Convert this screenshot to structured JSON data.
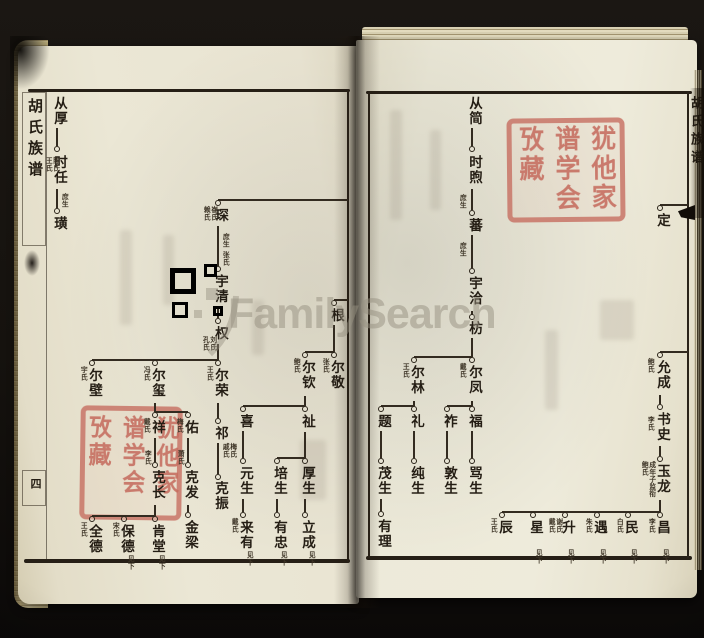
{
  "watermark": {
    "text": "FamilySearch"
  },
  "left_margin": {
    "title": "胡氏族谱",
    "page_mark": "四"
  },
  "right_margin": {
    "title": "胡氏族谱"
  },
  "seal": {
    "text": "犹他家谱学会攷藏"
  },
  "tree": {
    "labels": [
      {
        "t": "从厚",
        "x": 57,
        "y": 96
      },
      {
        "t": "时任",
        "x": 57,
        "y": 155
      },
      {
        "t": "璜",
        "x": 57,
        "y": 216
      },
      {
        "t": "琛",
        "x": 218,
        "y": 208
      },
      {
        "t": "宇清",
        "x": 218,
        "y": 274
      },
      {
        "t": "权",
        "x": 218,
        "y": 326
      },
      {
        "t": "尔壁",
        "x": 92,
        "y": 368
      },
      {
        "t": "尔玺",
        "x": 155,
        "y": 368
      },
      {
        "t": "尔荣",
        "x": 218,
        "y": 368
      },
      {
        "t": "祁",
        "x": 218,
        "y": 426
      },
      {
        "t": "克振",
        "x": 218,
        "y": 481
      },
      {
        "t": "祥",
        "x": 155,
        "y": 420
      },
      {
        "t": "佑",
        "x": 188,
        "y": 420
      },
      {
        "t": "克长",
        "x": 155,
        "y": 470
      },
      {
        "t": "克发",
        "x": 188,
        "y": 470
      },
      {
        "t": "金梁",
        "x": 188,
        "y": 520
      },
      {
        "t": "全德",
        "x": 92,
        "y": 524
      },
      {
        "t": "保德",
        "x": 124,
        "y": 524
      },
      {
        "t": "肯堂",
        "x": 155,
        "y": 524
      },
      {
        "t": "根",
        "x": 334,
        "y": 308
      },
      {
        "t": "尔敬",
        "x": 334,
        "y": 360
      },
      {
        "t": "尔钦",
        "x": 305,
        "y": 360
      },
      {
        "t": "喜",
        "x": 243,
        "y": 414
      },
      {
        "t": "祉",
        "x": 305,
        "y": 414
      },
      {
        "t": "元生",
        "x": 243,
        "y": 466
      },
      {
        "t": "来有",
        "x": 243,
        "y": 520
      },
      {
        "t": "培生",
        "x": 277,
        "y": 466
      },
      {
        "t": "厚生",
        "x": 305,
        "y": 466
      },
      {
        "t": "有忠",
        "x": 277,
        "y": 520
      },
      {
        "t": "立成",
        "x": 305,
        "y": 520
      },
      {
        "t": "从简",
        "x": 472,
        "y": 96
      },
      {
        "t": "时煦",
        "x": 472,
        "y": 155
      },
      {
        "t": "蕃",
        "x": 472,
        "y": 218
      },
      {
        "t": "宇洽",
        "x": 472,
        "y": 276
      },
      {
        "t": "枋",
        "x": 472,
        "y": 321
      },
      {
        "t": "尔凤",
        "x": 472,
        "y": 365
      },
      {
        "t": "尔林",
        "x": 414,
        "y": 365
      },
      {
        "t": "祚",
        "x": 447,
        "y": 414
      },
      {
        "t": "福",
        "x": 472,
        "y": 414
      },
      {
        "t": "敦生",
        "x": 447,
        "y": 466
      },
      {
        "t": "骂生",
        "x": 472,
        "y": 466
      },
      {
        "t": "题",
        "x": 381,
        "y": 414
      },
      {
        "t": "礼",
        "x": 414,
        "y": 414
      },
      {
        "t": "茂生",
        "x": 381,
        "y": 466
      },
      {
        "t": "纯生",
        "x": 414,
        "y": 466
      },
      {
        "t": "有理",
        "x": 381,
        "y": 519
      },
      {
        "t": "定",
        "x": 660,
        "y": 213
      },
      {
        "t": "允成",
        "x": 660,
        "y": 360
      },
      {
        "t": "书史",
        "x": 660,
        "y": 412
      },
      {
        "t": "玉龙",
        "x": 660,
        "y": 464
      },
      {
        "t": "辰",
        "x": 502,
        "y": 520
      },
      {
        "t": "星",
        "x": 533,
        "y": 520
      },
      {
        "t": "升",
        "x": 565,
        "y": 520
      },
      {
        "t": "遇",
        "x": 597,
        "y": 520
      },
      {
        "t": "民",
        "x": 628,
        "y": 520
      },
      {
        "t": "昌",
        "x": 660,
        "y": 520
      }
    ],
    "annots": [
      {
        "t": "陈氏王氏",
        "x": 48,
        "y": 157,
        "h": 16
      },
      {
        "t": "庶生",
        "x": 64,
        "y": 193
      },
      {
        "t": "崔氏赖氏",
        "x": 206,
        "y": 206,
        "h": 16
      },
      {
        "t": "庶生",
        "x": 225,
        "y": 233
      },
      {
        "t": "张氏",
        "x": 225,
        "y": 251
      },
      {
        "t": "刘氏孔氏",
        "x": 205,
        "y": 336,
        "h": 16
      },
      {
        "t": "宇氏",
        "x": 83,
        "y": 366
      },
      {
        "t": "冯氏",
        "x": 146,
        "y": 366
      },
      {
        "t": "王氏",
        "x": 209,
        "y": 366
      },
      {
        "t": "梅氏戚氏",
        "x": 225,
        "y": 443,
        "h": 16
      },
      {
        "t": "戴氏",
        "x": 146,
        "y": 418
      },
      {
        "t": "梅氏",
        "x": 179,
        "y": 418
      },
      {
        "t": "李氏",
        "x": 147,
        "y": 450
      },
      {
        "t": "萧氏",
        "x": 180,
        "y": 450
      },
      {
        "t": "王氏",
        "x": 83,
        "y": 522
      },
      {
        "t": "宋氏",
        "x": 115,
        "y": 522
      },
      {
        "t": "见下",
        "x": 130,
        "y": 555
      },
      {
        "t": "见下",
        "x": 161,
        "y": 555
      },
      {
        "t": "张氏",
        "x": 325,
        "y": 358
      },
      {
        "t": "鲍氏",
        "x": 296,
        "y": 358
      },
      {
        "t": "戴氏",
        "x": 234,
        "y": 518
      },
      {
        "t": "见下",
        "x": 249,
        "y": 551
      },
      {
        "t": "见下",
        "x": 283,
        "y": 551
      },
      {
        "t": "见下",
        "x": 311,
        "y": 551
      },
      {
        "t": "庶生",
        "x": 462,
        "y": 194
      },
      {
        "t": "庶生",
        "x": 462,
        "y": 242
      },
      {
        "t": "戴氏",
        "x": 462,
        "y": 363
      },
      {
        "t": "王氏",
        "x": 405,
        "y": 363
      },
      {
        "t": "鲍氏",
        "x": 650,
        "y": 358
      },
      {
        "t": "李氏",
        "x": 650,
        "y": 416
      },
      {
        "t": "成年子监衔鲍氏",
        "x": 644,
        "y": 461,
        "h": 38
      },
      {
        "t": "王氏",
        "x": 493,
        "y": 518
      },
      {
        "t": "谢氏戴氏",
        "x": 551,
        "y": 518,
        "h": 16
      },
      {
        "t": "朱氏",
        "x": 588,
        "y": 518
      },
      {
        "t": "白氏",
        "x": 619,
        "y": 518
      },
      {
        "t": "李氏",
        "x": 651,
        "y": 518
      },
      {
        "t": "见下",
        "x": 538,
        "y": 549
      },
      {
        "t": "见下",
        "x": 570,
        "y": 549
      },
      {
        "t": "见下",
        "x": 602,
        "y": 549
      },
      {
        "t": "见下",
        "x": 633,
        "y": 549
      },
      {
        "t": "见下",
        "x": 665,
        "y": 549
      }
    ],
    "circles": [
      [
        57,
        149
      ],
      [
        57,
        211
      ],
      [
        218,
        203
      ],
      [
        218,
        269
      ],
      [
        218,
        321
      ],
      [
        92,
        363
      ],
      [
        155,
        363
      ],
      [
        218,
        363
      ],
      [
        218,
        421
      ],
      [
        218,
        477
      ],
      [
        155,
        415
      ],
      [
        188,
        415
      ],
      [
        155,
        465
      ],
      [
        188,
        465
      ],
      [
        188,
        515
      ],
      [
        92,
        519
      ],
      [
        124,
        519
      ],
      [
        155,
        519
      ],
      [
        334,
        303
      ],
      [
        305,
        355
      ],
      [
        334,
        355
      ],
      [
        243,
        409
      ],
      [
        305,
        409
      ],
      [
        243,
        461
      ],
      [
        243,
        515
      ],
      [
        277,
        461
      ],
      [
        305,
        461
      ],
      [
        277,
        515
      ],
      [
        305,
        515
      ],
      [
        472,
        149
      ],
      [
        472,
        213
      ],
      [
        472,
        271
      ],
      [
        472,
        317
      ],
      [
        414,
        360
      ],
      [
        472,
        360
      ],
      [
        447,
        409
      ],
      [
        472,
        409
      ],
      [
        381,
        409
      ],
      [
        414,
        409
      ],
      [
        447,
        461
      ],
      [
        472,
        461
      ],
      [
        381,
        461
      ],
      [
        414,
        461
      ],
      [
        381,
        514
      ],
      [
        660,
        208
      ],
      [
        660,
        355
      ],
      [
        660,
        407
      ],
      [
        660,
        459
      ],
      [
        502,
        515
      ],
      [
        533,
        515
      ],
      [
        565,
        515
      ],
      [
        597,
        515
      ],
      [
        628,
        515
      ],
      [
        660,
        515
      ]
    ],
    "vlines": [
      [
        57,
        128,
        146
      ],
      [
        57,
        189,
        208
      ],
      [
        218,
        226,
        266
      ],
      [
        218,
        309,
        318
      ],
      [
        218,
        344,
        360
      ],
      [
        218,
        403,
        418
      ],
      [
        218,
        443,
        474
      ],
      [
        155,
        403,
        412
      ],
      [
        155,
        438,
        462
      ],
      [
        188,
        438,
        462
      ],
      [
        188,
        505,
        512
      ],
      [
        155,
        505,
        516
      ],
      [
        334,
        325,
        352
      ],
      [
        305,
        396,
        406
      ],
      [
        243,
        431,
        458
      ],
      [
        243,
        499,
        512
      ],
      [
        305,
        432,
        458
      ],
      [
        277,
        499,
        512
      ],
      [
        305,
        499,
        512
      ],
      [
        472,
        128,
        146
      ],
      [
        472,
        189,
        210
      ],
      [
        472,
        235,
        268
      ],
      [
        472,
        311,
        315
      ],
      [
        472,
        338,
        357
      ],
      [
        472,
        401,
        406
      ],
      [
        414,
        401,
        406
      ],
      [
        447,
        431,
        458
      ],
      [
        472,
        431,
        458
      ],
      [
        381,
        431,
        458
      ],
      [
        414,
        431,
        458
      ],
      [
        381,
        499,
        511
      ],
      [
        660,
        395,
        404
      ],
      [
        660,
        446,
        456
      ],
      [
        660,
        500,
        512
      ]
    ],
    "hlines": [
      [
        200,
        218,
        348
      ],
      [
        300,
        334,
        348
      ],
      [
        360,
        92,
        218
      ],
      [
        412,
        155,
        188
      ],
      [
        516,
        92,
        155
      ],
      [
        352,
        305,
        334
      ],
      [
        406,
        243,
        305
      ],
      [
        458,
        277,
        305
      ],
      [
        357,
        414,
        472
      ],
      [
        406,
        447,
        472
      ],
      [
        406,
        381,
        414
      ],
      [
        205,
        660,
        688
      ],
      [
        352,
        660,
        688
      ],
      [
        512,
        502,
        660
      ]
    ]
  }
}
